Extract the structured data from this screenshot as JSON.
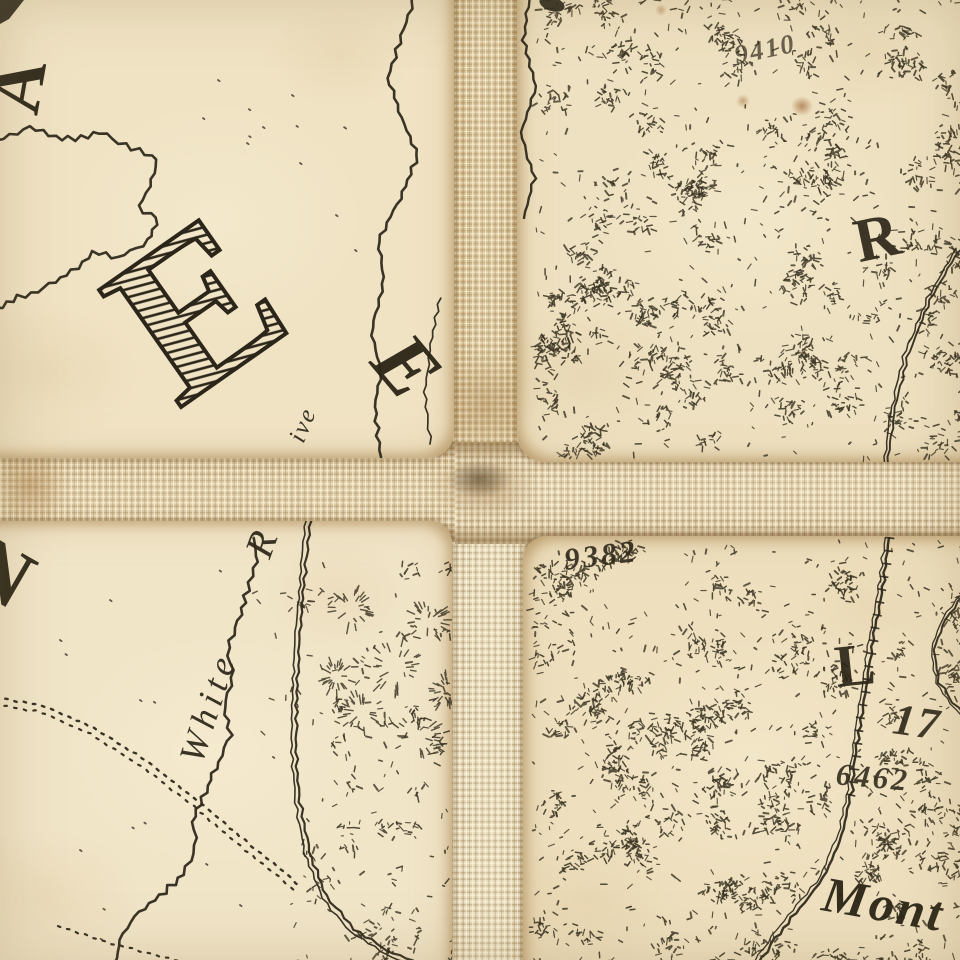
{
  "artifact": {
    "type_label": "Antique dissected map segment on linen backing",
    "paper_color": "#f0e3c4",
    "cloth_color": "#d6c198",
    "ink_color": "#2f2a1e",
    "stipple_color": "#36301f"
  },
  "labels": [
    {
      "id": "corner-letter-a",
      "text": "A",
      "x": 18,
      "y": 86,
      "size": 74,
      "rotate": -80,
      "style": "big-serif",
      "spacing": 0,
      "opacity": 0.95
    },
    {
      "id": "giant-letter-e",
      "text": "E",
      "x": 196,
      "y": 308,
      "size": 218,
      "rotate": -35,
      "style": "hatched",
      "spacing": 0,
      "opacity": 1
    },
    {
      "id": "river-name-initial-e",
      "text": "E",
      "x": 407,
      "y": 366,
      "size": 82,
      "rotate": 50,
      "style": "italic-bold",
      "spacing": 0,
      "opacity": 0.95
    },
    {
      "id": "river-label-fragment-ive",
      "text": "ive",
      "x": 303,
      "y": 425,
      "size": 25,
      "rotate": -68,
      "style": "italic",
      "spacing": 2,
      "opacity": 0.95
    },
    {
      "id": "white-river-r",
      "text": "R",
      "x": 261,
      "y": 544,
      "size": 40,
      "rotate": -70,
      "style": "italic",
      "spacing": 0,
      "opacity": 0.95
    },
    {
      "id": "white-river-white",
      "text": "White",
      "x": 208,
      "y": 707,
      "size": 36,
      "rotate": -72,
      "style": "italic",
      "spacing": 6,
      "opacity": 0.95
    },
    {
      "id": "big-letter-r",
      "text": "R",
      "x": 877,
      "y": 238,
      "size": 62,
      "rotate": -12,
      "style": "big-serif",
      "spacing": 0,
      "opacity": 0.92
    },
    {
      "id": "big-letter-l",
      "text": "L",
      "x": 855,
      "y": 665,
      "size": 60,
      "rotate": -6,
      "style": "big-serif",
      "spacing": 0,
      "opacity": 0.92
    },
    {
      "id": "spot-elevation-9410",
      "text": "9410",
      "x": 765,
      "y": 49,
      "size": 27,
      "rotate": -12,
      "style": "script",
      "spacing": 2,
      "opacity": 0.7
    },
    {
      "id": "spot-elevation-9382",
      "text": "9382",
      "x": 601,
      "y": 555,
      "size": 31,
      "rotate": -7,
      "style": "script",
      "spacing": 3,
      "opacity": 0.92
    },
    {
      "id": "number-17",
      "text": "17",
      "x": 917,
      "y": 722,
      "size": 44,
      "rotate": 8,
      "style": "script",
      "spacing": 2,
      "opacity": 0.92
    },
    {
      "id": "spot-elevation-6462",
      "text": "6462",
      "x": 873,
      "y": 777,
      "size": 31,
      "rotate": 5,
      "style": "script",
      "spacing": 3,
      "opacity": 0.9
    },
    {
      "id": "place-name-mont",
      "text": "Mont",
      "x": 884,
      "y": 904,
      "size": 50,
      "rotate": 10,
      "style": "italic-bold",
      "spacing": 3,
      "opacity": 0.95
    },
    {
      "id": "edge-letter-fragment",
      "text": "N",
      "x": 0,
      "y": 572,
      "size": 84,
      "rotate": 30,
      "style": "big-serif",
      "spacing": 0,
      "opacity": 0.95
    }
  ]
}
